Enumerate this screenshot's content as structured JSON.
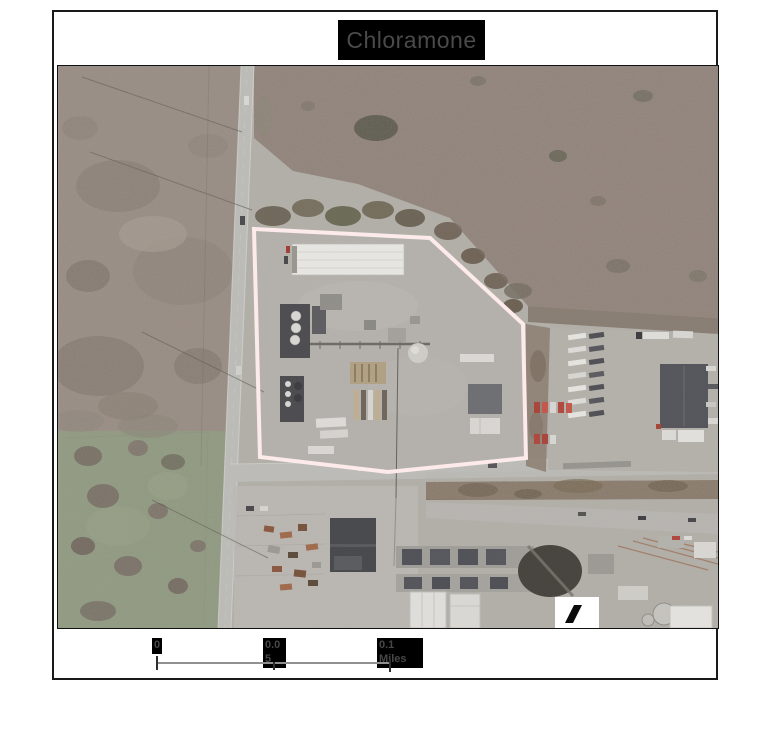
{
  "page": {
    "background": "#ffffff"
  },
  "header": {
    "title": "Chloramone",
    "title_bg": "#000000",
    "title_color": "#4a4a4a"
  },
  "map": {
    "kind": "aerial-photograph",
    "site_boundary_color": "#fdeaea",
    "north_marker": "black-slash-on-white",
    "palette": {
      "scrubland": "#968a82",
      "brown_field": "#8e8078",
      "grass_field": "#8d987e",
      "road": "#bcbcb8",
      "concrete": "#b2afa9",
      "warehouse_roof": "#e8e7e3",
      "dark_roof": "#53545a",
      "berm": "#867767"
    }
  },
  "scale_bar": {
    "labels": [
      "0",
      "0.05",
      "0.1 Miles"
    ],
    "label_bg": "#000000",
    "label_color": "#474747",
    "line_color": "#909090"
  }
}
